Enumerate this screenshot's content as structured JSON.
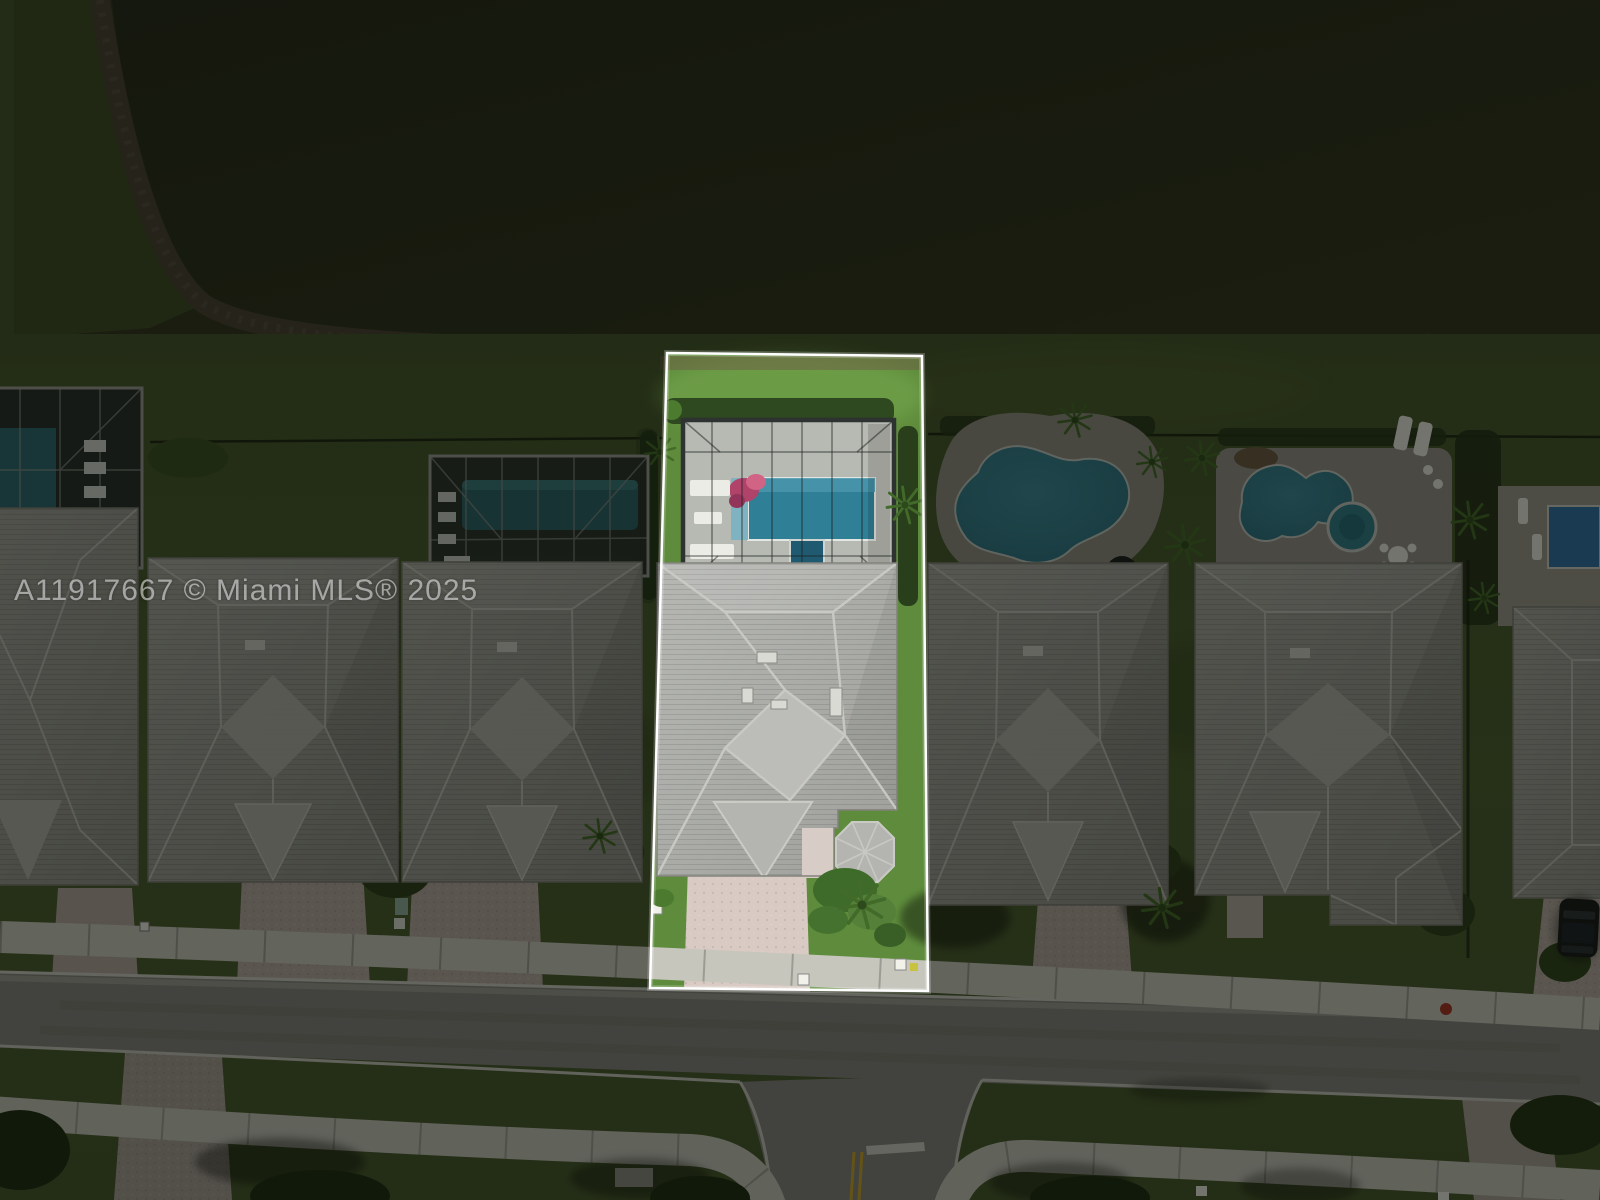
{
  "watermark": {
    "text": "A11917667 © Miami MLS® 2025"
  },
  "colors": {
    "water": "#292d1b",
    "shore_bank": "#453f32",
    "lawn": "#475a2d",
    "lot_grass": "#5e8c3c",
    "roof_highlight": "#abaca8",
    "roof_neighbor": "#9b9b95",
    "pool_teal": "#2f7f96",
    "pool_blue": "#2e6fa8",
    "deck": "#918f87",
    "road": "#83837d",
    "sidewalk": "#c6c6bd",
    "paver_driveway": "#d9cac3",
    "highlight_border": "#ffffff",
    "dim_overlay": "rgba(7,9,4,0.52)",
    "lane_line_yellow": "#c8a32c"
  }
}
